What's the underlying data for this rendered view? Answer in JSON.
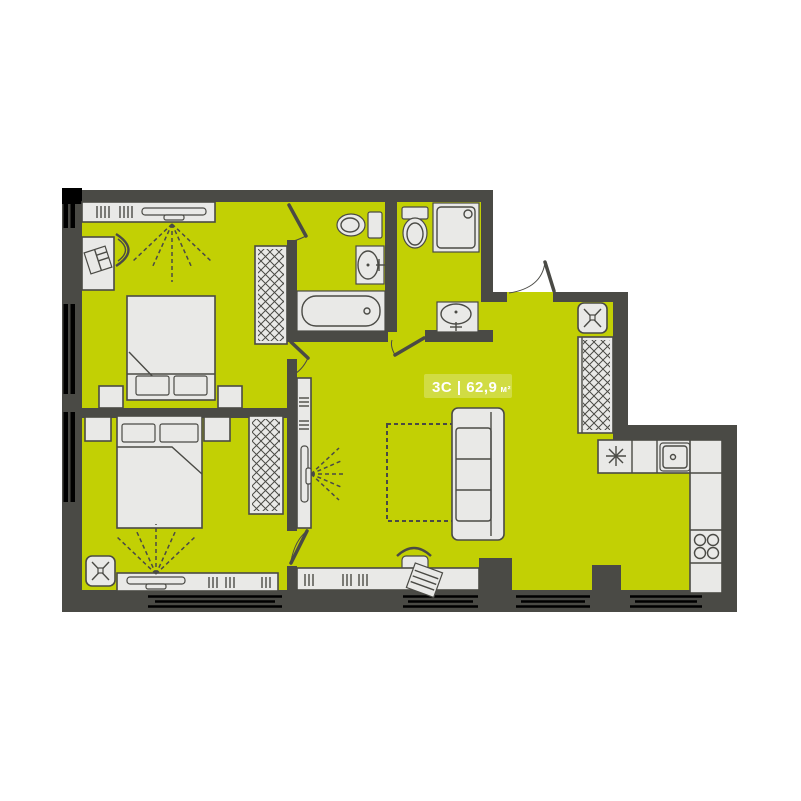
{
  "area_label": {
    "text": "3С | 62,9",
    "unit": "м²"
  },
  "colors": {
    "floor": "#c2d004",
    "wall": "#4a4a45",
    "furn": "#e9e9e7",
    "line": "#4a4a45",
    "window_bar": "#000000",
    "label_text": "#ffffff",
    "page_bg": "#ffffff"
  },
  "icons": [
    "double-bed-icon",
    "pillow-icon",
    "nightstand-icon",
    "wardrobe-icon",
    "desk-icon",
    "chair-icon",
    "tv-icon",
    "bookshelf-icon",
    "toilet-icon",
    "sink-icon",
    "bathtub-icon",
    "shower-icon",
    "sofa-icon",
    "rug-icon",
    "vent-shaft-icon",
    "kitchen-sink-icon",
    "cooktop-icon",
    "burner-stove-icon",
    "door-leaf-icon",
    "window-icon",
    "entrance-door-icon"
  ]
}
